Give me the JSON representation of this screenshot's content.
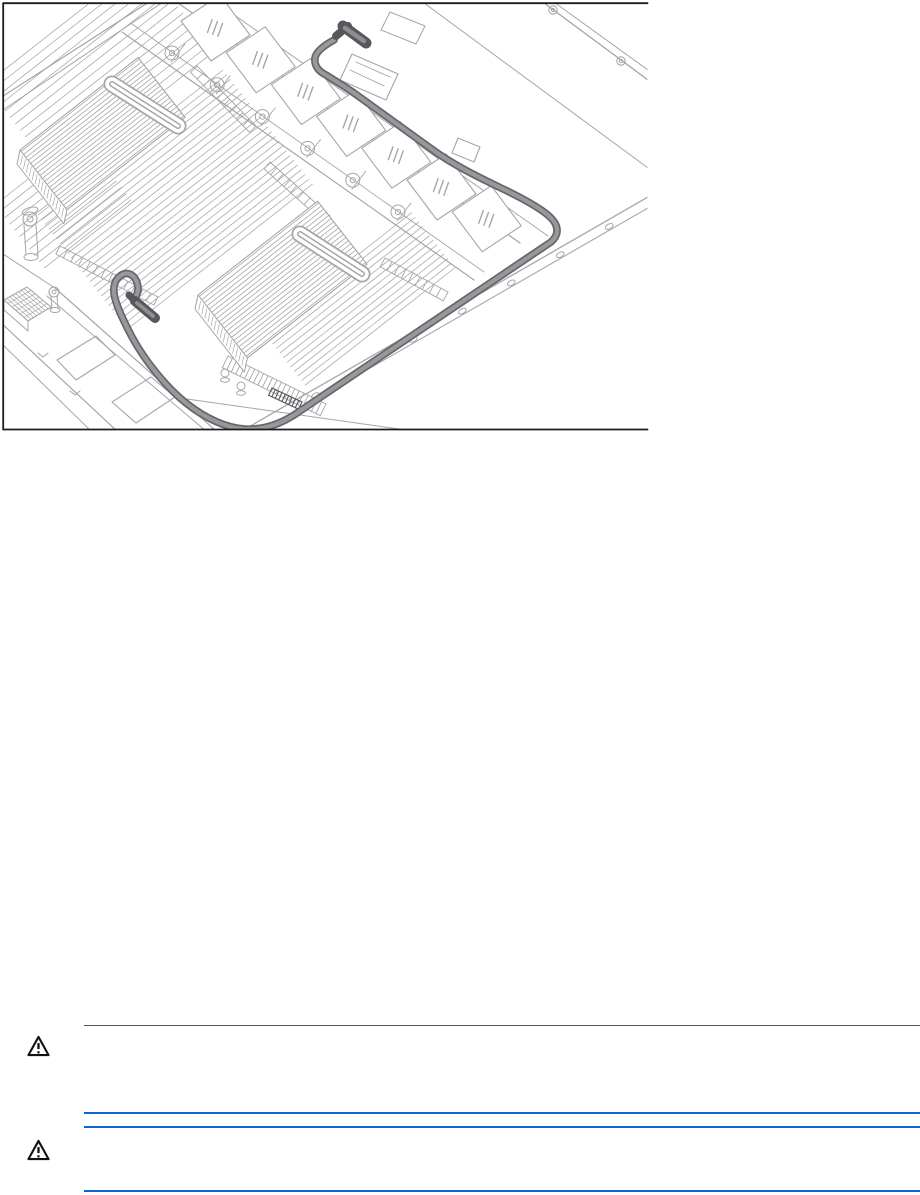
{
  "page": {
    "width_px": 920,
    "height_px": 1195,
    "background": "#ffffff"
  },
  "figure": {
    "alt": "Isometric line drawing of a server interior showing a highlighted cable routed from a connector beside the fan bank, along the right chassis edge, around the front corner, to a connector at the front-left of the system board",
    "frame_color": "#1c1c1c",
    "line_color": "#a6a6aa",
    "cable_color": "#98989c",
    "cable_edge_color": "#66666a",
    "connector_color": "#58585c"
  },
  "cautions": {
    "rule_color": "#1062db",
    "icon_color": "#111111",
    "items": [
      {
        "icon": "warning-triangle-icon",
        "body_text": ""
      },
      {
        "icon": "warning-triangle-icon",
        "body_text": ""
      }
    ]
  }
}
